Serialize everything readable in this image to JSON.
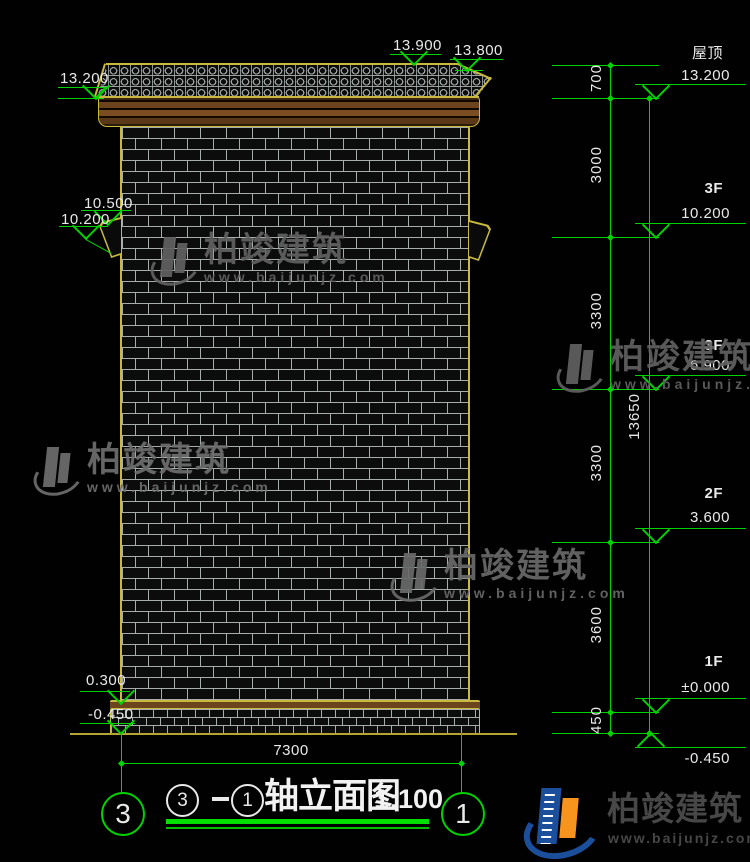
{
  "drawing": {
    "title": {
      "axis_start": "3",
      "axis_end": "1",
      "name": "轴立面图",
      "scale": "1:100"
    },
    "axis_bubbles": {
      "left": "3",
      "right": "1"
    },
    "bottom_dim": "7300",
    "left_elevations": [
      "13.200",
      "13.900",
      "13.800",
      "10.500",
      "10.200",
      "0.300",
      "-0.450"
    ],
    "right_levels": [
      {
        "label": "屋顶",
        "elev": "13.200"
      },
      {
        "label": "3F",
        "elev": "10.200"
      },
      {
        "label": "3F",
        "elev": "6.900"
      },
      {
        "label": "2F",
        "elev": "3.600"
      },
      {
        "label": "1F",
        "elev": "±0.000"
      },
      {
        "label": "",
        "elev": "-0.450"
      }
    ],
    "chain_dims": [
      "700",
      "3000",
      "3300",
      "3300",
      "3600",
      "450"
    ],
    "overall_dim": "13650"
  },
  "watermark": {
    "brand": "柏竣建筑",
    "url": "www.baijunjz.com"
  },
  "logo": {
    "brand": "柏竣建筑",
    "url": "www.baijunjz.com"
  },
  "colors": {
    "dimension_green": "#00d400",
    "outline_yellow": "#c9b93f",
    "text_white": "#e9e9e9",
    "background": "#000000",
    "logo_blue": "#1b4f9c",
    "logo_orange": "#f7941d"
  }
}
